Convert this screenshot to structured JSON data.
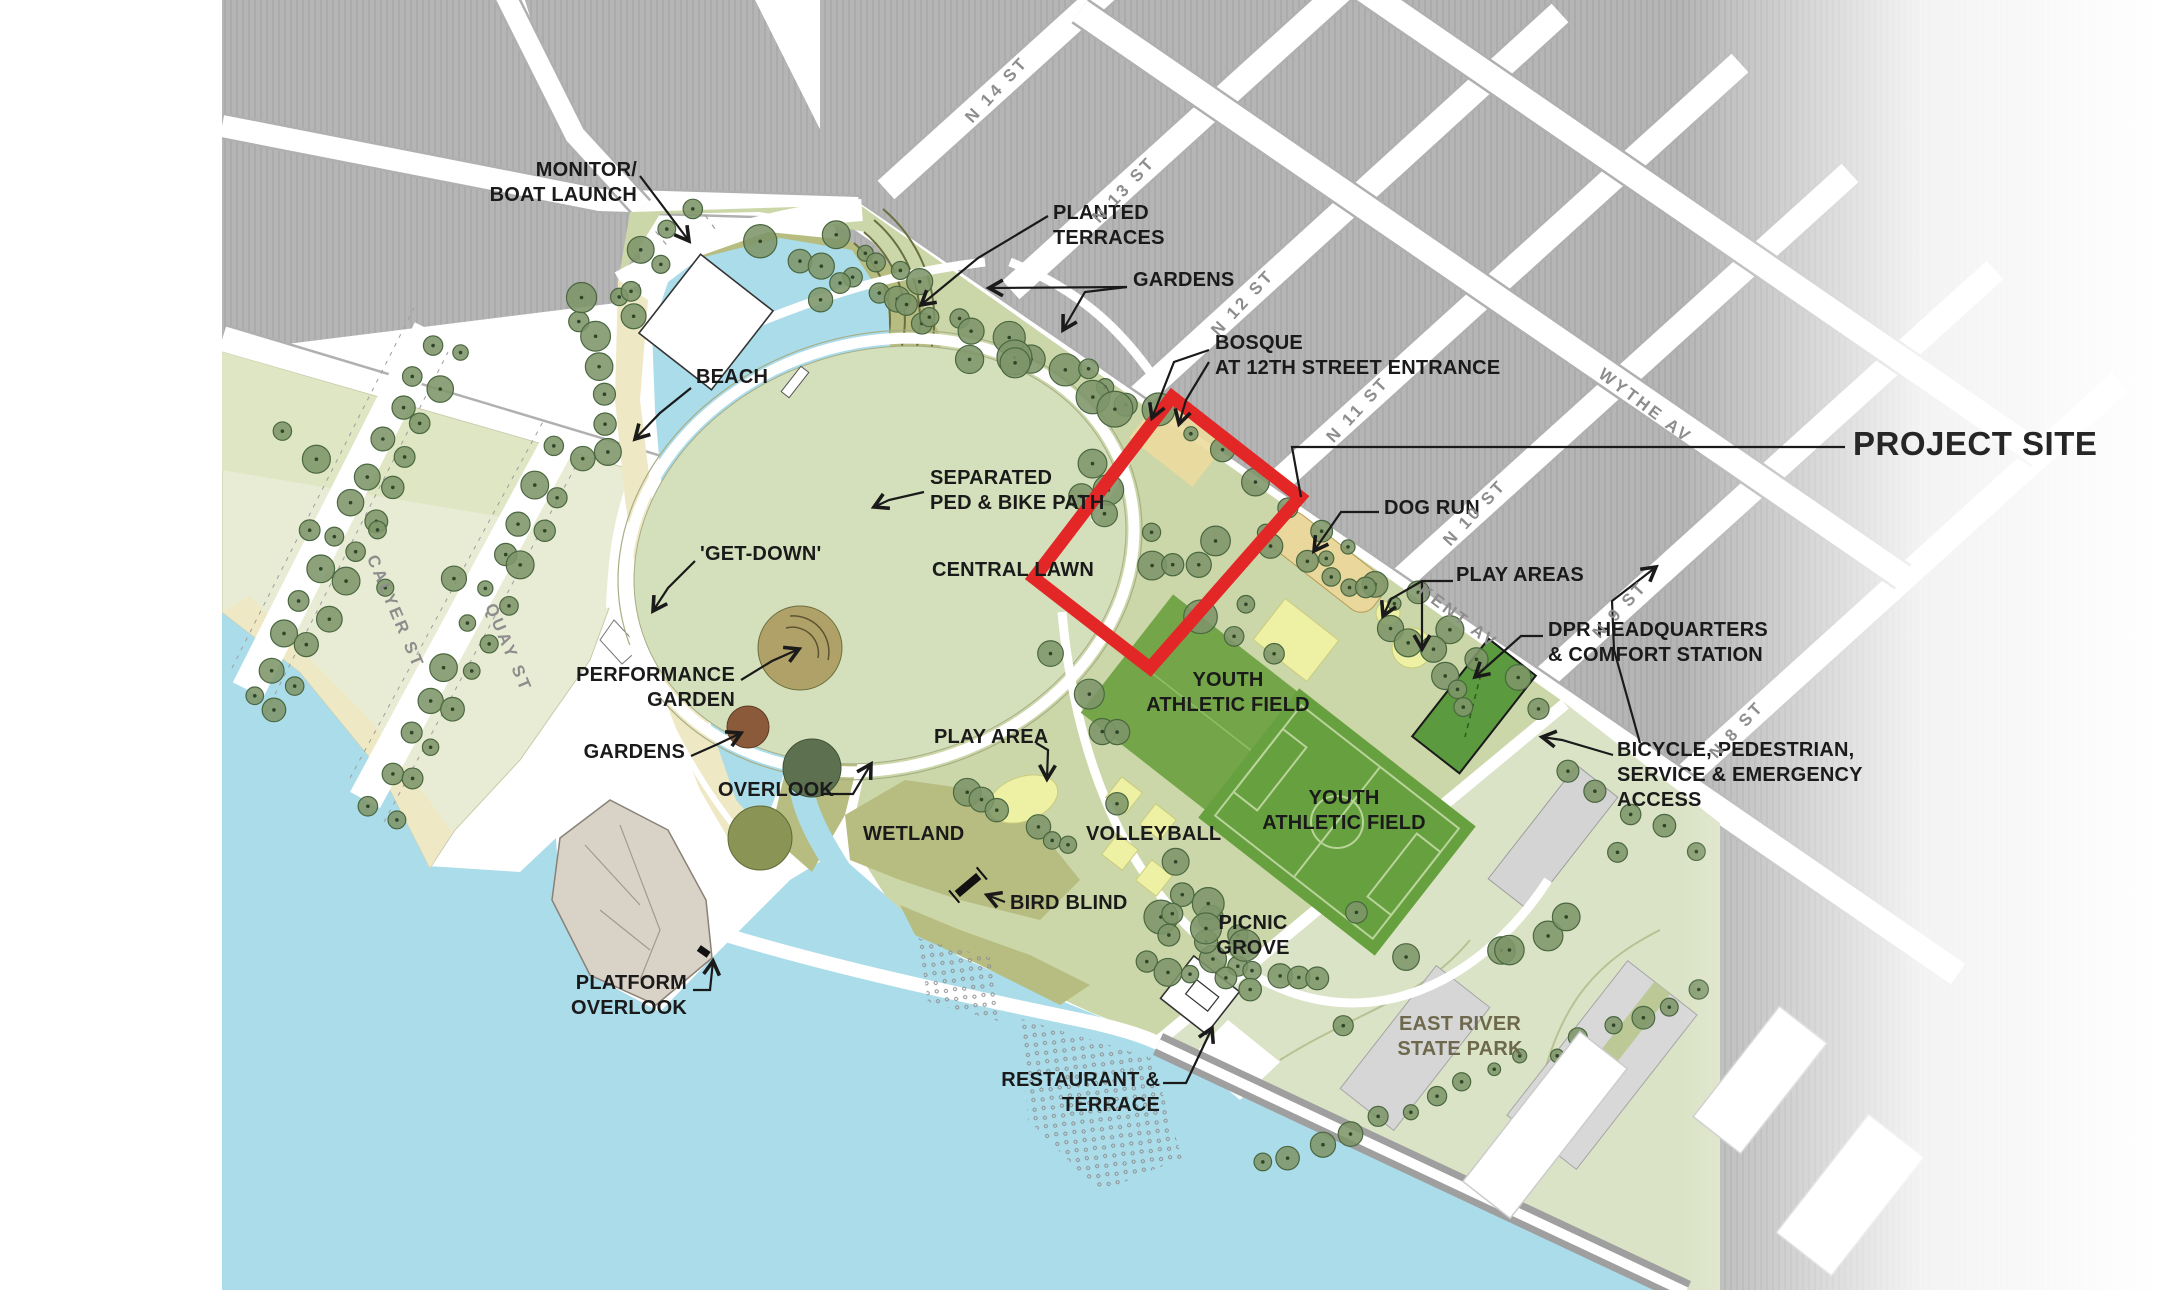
{
  "colors": {
    "water": "#aadcea",
    "park_green": "#cbd7a8",
    "lawn": "#d4dfbb",
    "olive": "#b7bd80",
    "beach": "#efe8c5",
    "field_green": "#74a649",
    "field_green_dark": "#67a03e",
    "court_yellow": "#eef0a4",
    "dogrun_tan": "#e9d79c",
    "block_gray": "#b5b5b5",
    "ersp_green": "#dbe3c6",
    "dpr_green": "#5b9a3e",
    "rock": "#d9d3c7",
    "project_red": "#e32726",
    "label": "#1a1a1a",
    "street_label": "#8d8d8d",
    "ersp_text": "#6e684c",
    "tree": "#7d9569"
  },
  "map": {
    "feature_labels": [
      {
        "id": "monitor-boat-launch",
        "text": "MONITOR/\nBOAT LAUNCH",
        "x": 637,
        "y": 158,
        "align": "right"
      },
      {
        "id": "planted-terraces",
        "text": "PLANTED\nTERRACES",
        "x": 1053,
        "y": 201,
        "align": "left"
      },
      {
        "id": "gardens-upper",
        "text": "GARDENS",
        "x": 1133,
        "y": 268,
        "align": "left"
      },
      {
        "id": "bosque",
        "text": "BOSQUE\nAT 12TH STREET ENTRANCE",
        "x": 1215,
        "y": 331,
        "align": "left"
      },
      {
        "id": "project-site",
        "text": "PROJECT SITE",
        "x": 1853,
        "y": 426,
        "align": "left",
        "cls": "project-site"
      },
      {
        "id": "beach",
        "text": "BEACH",
        "x": 696,
        "y": 365,
        "align": "left"
      },
      {
        "id": "get-down",
        "text": "'GET-DOWN'",
        "x": 700,
        "y": 542,
        "align": "left"
      },
      {
        "id": "separated-ped-bike-path",
        "text": "SEPARATED\nPED & BIKE PATH",
        "x": 930,
        "y": 466,
        "align": "left"
      },
      {
        "id": "central-lawn",
        "text": "CENTRAL LAWN",
        "x": 932,
        "y": 558,
        "align": "left"
      },
      {
        "id": "performance-garden",
        "text": "PERFORMANCE\nGARDEN",
        "x": 735,
        "y": 663,
        "align": "right"
      },
      {
        "id": "gardens-lower",
        "text": "GARDENS",
        "x": 685,
        "y": 740,
        "align": "right"
      },
      {
        "id": "overlook",
        "text": "OVERLOOK",
        "x": 718,
        "y": 778,
        "align": "left"
      },
      {
        "id": "play-area",
        "text": "PLAY AREA",
        "x": 934,
        "y": 725,
        "align": "left"
      },
      {
        "id": "wetland",
        "text": "WETLAND",
        "x": 863,
        "y": 822,
        "align": "left"
      },
      {
        "id": "bird-blind",
        "text": "BIRD BLIND",
        "x": 1010,
        "y": 891,
        "align": "left"
      },
      {
        "id": "volleyball",
        "text": "VOLLEYBALL",
        "x": 1086,
        "y": 822,
        "align": "left"
      },
      {
        "id": "youth-athletic-field-1",
        "text": "YOUTH\nATHLETIC FIELD",
        "x": 1228,
        "y": 668,
        "align": "center"
      },
      {
        "id": "youth-athletic-field-2",
        "text": "YOUTH\nATHLETIC FIELD",
        "x": 1344,
        "y": 786,
        "align": "center"
      },
      {
        "id": "picnic-grove",
        "text": "PICNIC\nGROVE",
        "x": 1253,
        "y": 911,
        "align": "center"
      },
      {
        "id": "dog-run",
        "text": "DOG RUN",
        "x": 1384,
        "y": 496,
        "align": "left"
      },
      {
        "id": "play-areas",
        "text": "PLAY AREAS",
        "x": 1456,
        "y": 563,
        "align": "left"
      },
      {
        "id": "dpr-headquarters",
        "text": "DPR HEADQUARTERS\n& COMFORT STATION",
        "x": 1548,
        "y": 618,
        "align": "left"
      },
      {
        "id": "bicycle-access",
        "text": "BICYCLE, PEDESTRIAN,\nSERVICE &  EMERGENCY\nACCESS",
        "x": 1617,
        "y": 738,
        "align": "left"
      },
      {
        "id": "platform-overlook",
        "text": "PLATFORM\nOVERLOOK",
        "x": 687,
        "y": 971,
        "align": "right"
      },
      {
        "id": "restaurant-terrace",
        "text": "RESTAURANT &\nTERRACE",
        "x": 1160,
        "y": 1068,
        "align": "right"
      },
      {
        "id": "east-river-state-park",
        "text": "EAST RIVER\nSTATE PARK",
        "x": 1460,
        "y": 1012,
        "align": "center",
        "cls": "ersp-label"
      }
    ],
    "street_labels": [
      {
        "id": "n14-st",
        "text": "N 14 ST",
        "x": 997,
        "y": 90,
        "rot": -47
      },
      {
        "id": "n13-st",
        "text": "N 13 ST",
        "x": 1124,
        "y": 190,
        "rot": -47
      },
      {
        "id": "n12-st",
        "text": "N 12 ST",
        "x": 1243,
        "y": 303,
        "rot": -47
      },
      {
        "id": "n11-st",
        "text": "N 11 ST",
        "x": 1358,
        "y": 410,
        "rot": -47
      },
      {
        "id": "n10-st",
        "text": "N 10 ST",
        "x": 1475,
        "y": 513,
        "rot": -47
      },
      {
        "id": "n9-st",
        "text": "N 9 ST",
        "x": 1620,
        "y": 610,
        "rot": -47
      },
      {
        "id": "n8-st",
        "text": "N 8 ST",
        "x": 1737,
        "y": 730,
        "rot": -47
      },
      {
        "id": "wythe-av",
        "text": "WYTHE AV",
        "x": 1645,
        "y": 406,
        "rot": 37
      },
      {
        "id": "kent-av",
        "text": "KENT AV",
        "x": 1458,
        "y": 617,
        "rot": 37
      },
      {
        "id": "calyer-st",
        "text": "CALYER ST",
        "x": 395,
        "y": 612,
        "rot": 67
      },
      {
        "id": "quay-st",
        "text": "QUAY ST",
        "x": 508,
        "y": 648,
        "rot": 67
      }
    ]
  }
}
